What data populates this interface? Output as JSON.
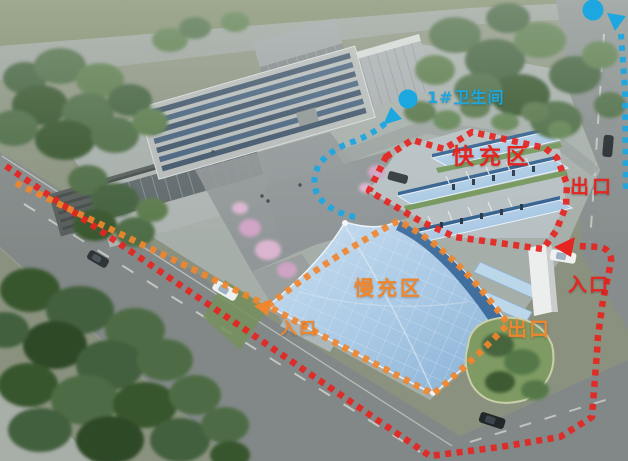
{
  "scene": {
    "description": "aerial rendering of an EV charging station campus with routed annotations",
    "labels": {
      "restroom": "1#卫生间",
      "fast_zone": "快充区",
      "fast_exit": "出口",
      "fast_entrance": "入口",
      "slow_zone": "慢充区",
      "slow_entrance": "入口",
      "slow_exit": "出口"
    },
    "colors": {
      "fast_route": "#e62420",
      "slow_route": "#f0862c",
      "walk_route": "#1ca7e0",
      "canopy_blue": "#9fc2de",
      "pv_panel": "#32608f"
    },
    "icons": {
      "restroom_pin": "filled-circle",
      "offsite_pin": "filled-circle-with-down-triangle",
      "fast_entrance_arrow": "triangle-left",
      "slow_entrance_arrow": "triangle-left",
      "walk_arrow": "triangle-down-left"
    }
  }
}
